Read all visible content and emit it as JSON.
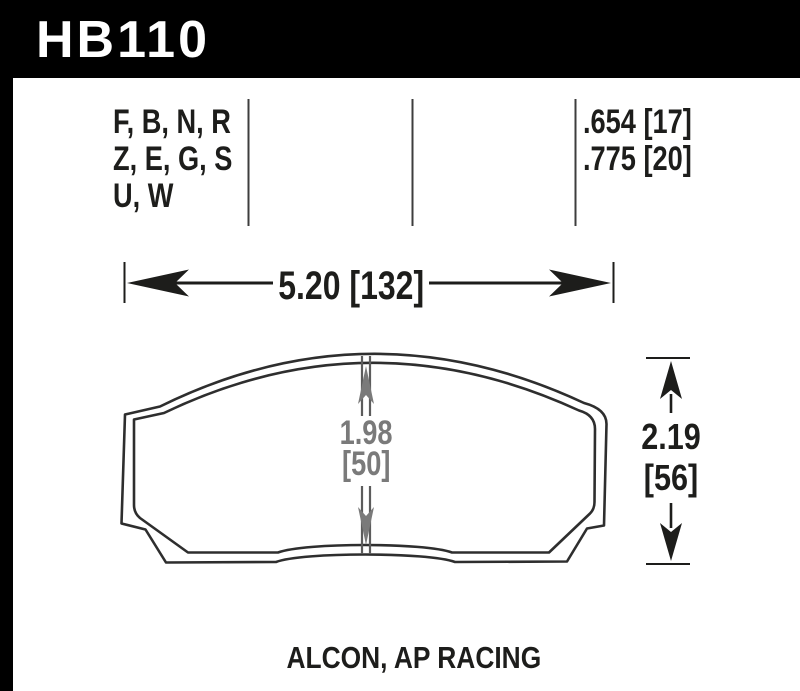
{
  "header": {
    "part_number": "HB110",
    "bg_color": "#000000",
    "text_color": "#ffffff"
  },
  "compound_table": {
    "compound_rows": [
      "F, B, N, R",
      "Z, E, G, S",
      "U, W"
    ],
    "thickness_rows": [
      ".654 [17]",
      ".775 [20]"
    ]
  },
  "dimensions": {
    "pad_width": "5.20 [132]",
    "pad_height_in": "2.19",
    "pad_height_mm": "[56]",
    "center_height_in": "1.98",
    "center_height_mm": "[50]"
  },
  "footer": {
    "applications": "ALCON, AP RACING"
  },
  "colors": {
    "ink": "#1d1d1b",
    "outline": "#2e2e2e",
    "divider": "#3d3d3d",
    "dim_gray": "#7a7a7a",
    "dim_gray_line": "#5c5c5c"
  }
}
